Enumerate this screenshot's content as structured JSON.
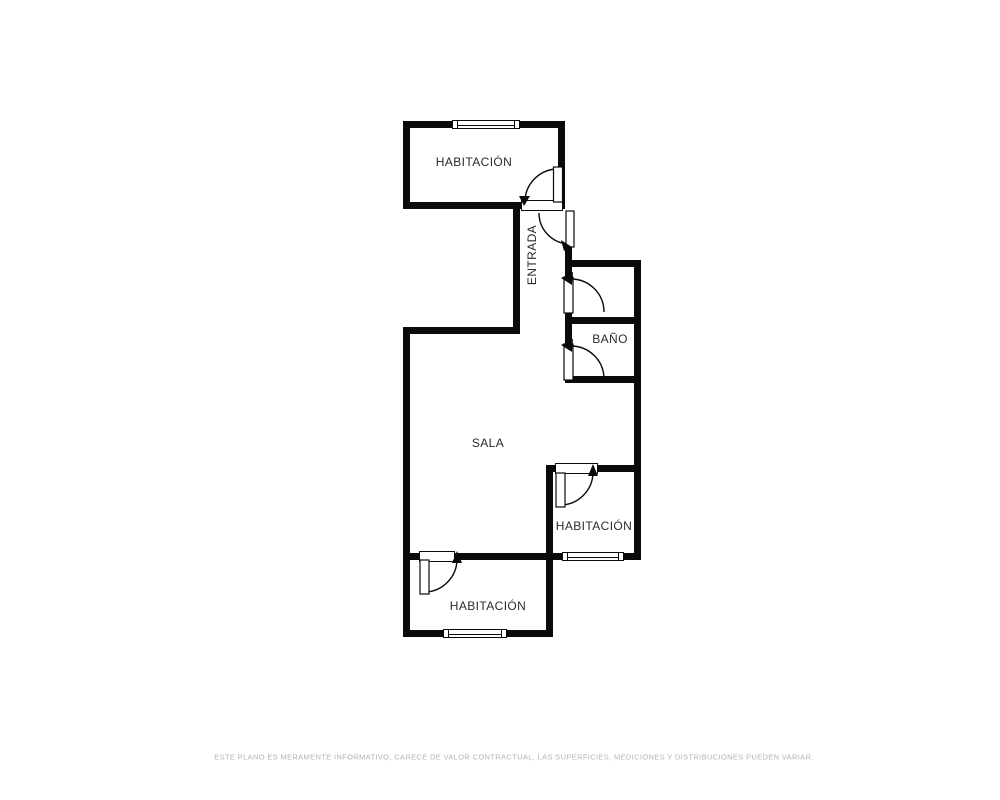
{
  "rooms": {
    "top_bedroom": {
      "label": "HABITACIÓN"
    },
    "entrance": {
      "label": "ENTRADA"
    },
    "bathroom": {
      "label": "BAÑO"
    },
    "living": {
      "label": "SALA"
    },
    "mid_bedroom": {
      "label": "HABITACIÓN"
    },
    "bottom_bedroom": {
      "label": "HABITACIÓN"
    }
  },
  "disclaimer": "ESTE PLANO ES MERAMENTE INFORMATIVO, CARECE DE VALOR CONTRACTUAL, LAS SUPERFICIES, MEDICIONES Y DISTRIBUCIONES PUEDEN VARIAR.",
  "colors": {
    "background": "#ffffff",
    "wall": "#0a0a0a",
    "label": "#2b2b2b",
    "disclaimer": "#b3b3b3"
  }
}
